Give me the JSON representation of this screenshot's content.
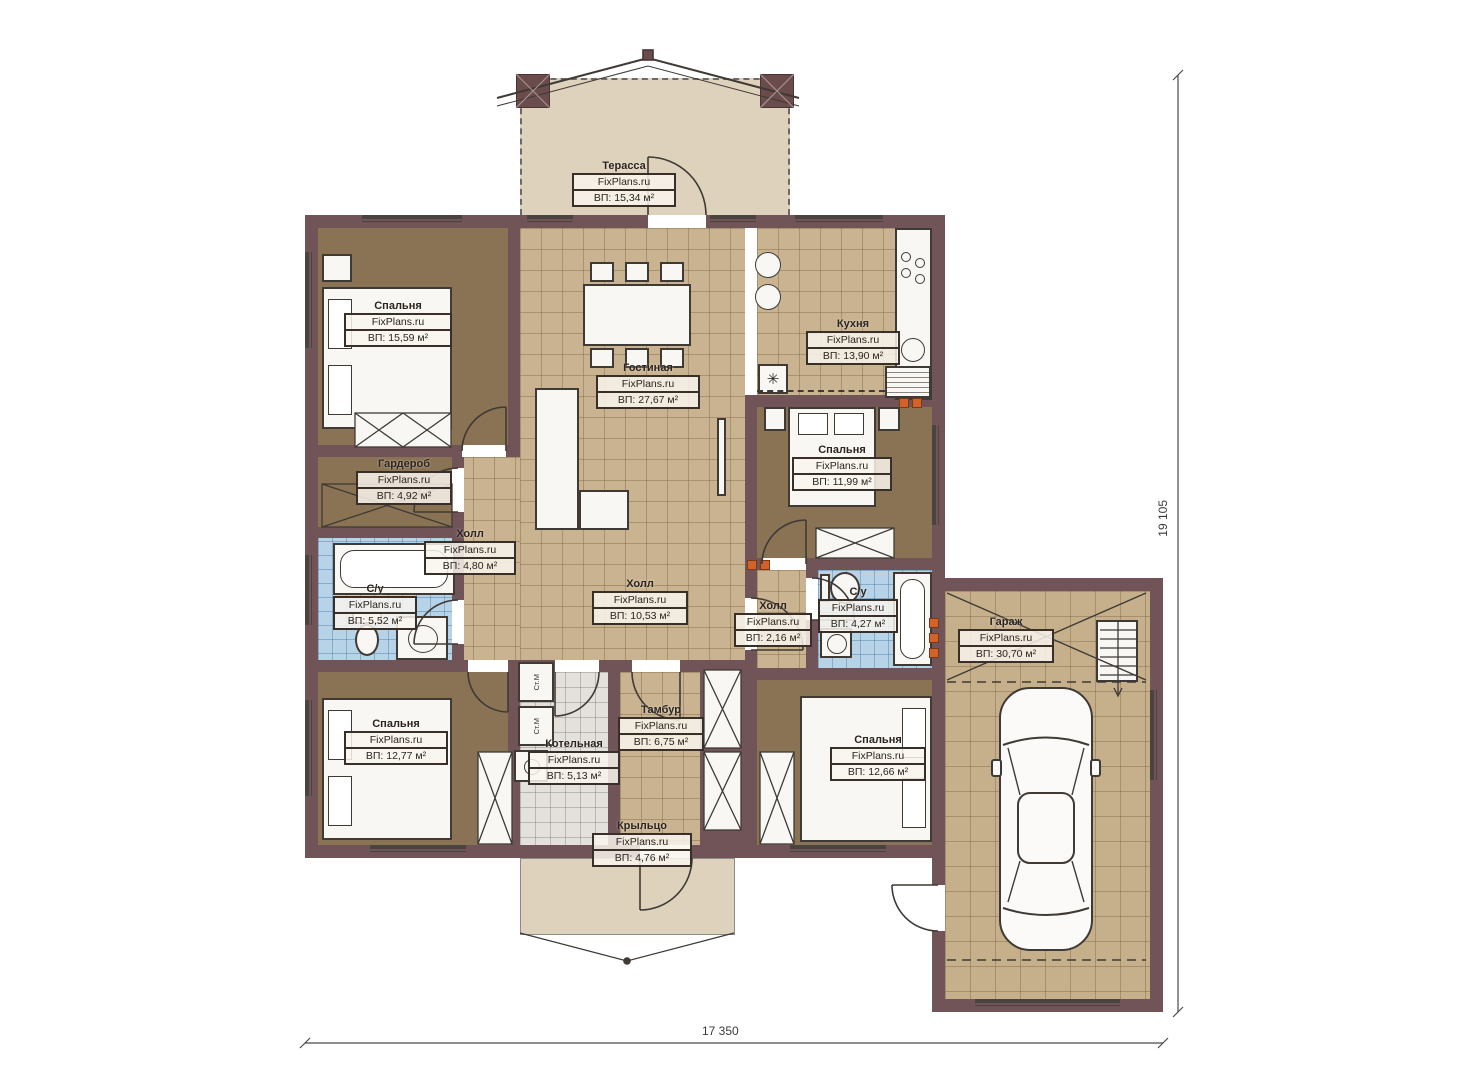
{
  "plan": {
    "brand": "FixPlans.ru",
    "rooms": [
      {
        "name": "Терасса",
        "area": "ВП: 15,34 м²"
      },
      {
        "name": "Спальня",
        "area": "ВП: 15,59 м²"
      },
      {
        "name": "Гостиная",
        "area": "ВП: 27,67 м²"
      },
      {
        "name": "Кухня",
        "area": "ВП: 13,90 м²"
      },
      {
        "name": "Спальня",
        "area": "ВП: 11,99 м²"
      },
      {
        "name": "Гардероб",
        "area": "ВП: 4,92 м²"
      },
      {
        "name": "Холл",
        "area": "ВП: 4,80 м²"
      },
      {
        "name": "С/у",
        "area": "ВП: 5,52 м²"
      },
      {
        "name": "Холл",
        "area": "ВП: 10,53 м²"
      },
      {
        "name": "Холл",
        "area": "ВП: 2,16 м²"
      },
      {
        "name": "С/у",
        "area": "ВП: 4,27 м²"
      },
      {
        "name": "Гараж",
        "area": "ВП: 30,70 м²"
      },
      {
        "name": "Спальня",
        "area": "ВП: 12,77 м²"
      },
      {
        "name": "Котельная",
        "area": "ВП: 5,13 м²"
      },
      {
        "name": "Тамбур",
        "area": "ВП: 6,75 м²"
      },
      {
        "name": "Спальня",
        "area": "ВП: 12,66 м²"
      },
      {
        "name": "Крыльцо",
        "area": "ВП: 4,76 м²"
      }
    ],
    "appliances": {
      "washer": "Ст.М"
    },
    "icons": {
      "fridge_snowflake": "✳"
    },
    "dimensions": {
      "width": "17 350",
      "height": "19 105"
    },
    "colors": {
      "wall": "#705457",
      "bedroom_floor": "#8a7254",
      "tile_floor": "#c9b390",
      "bath_floor": "#b7d3e8",
      "boiler_floor": "#e4e1dc",
      "terrace_floor": "#ded2bc",
      "vent_orange": "#d2622a"
    }
  }
}
